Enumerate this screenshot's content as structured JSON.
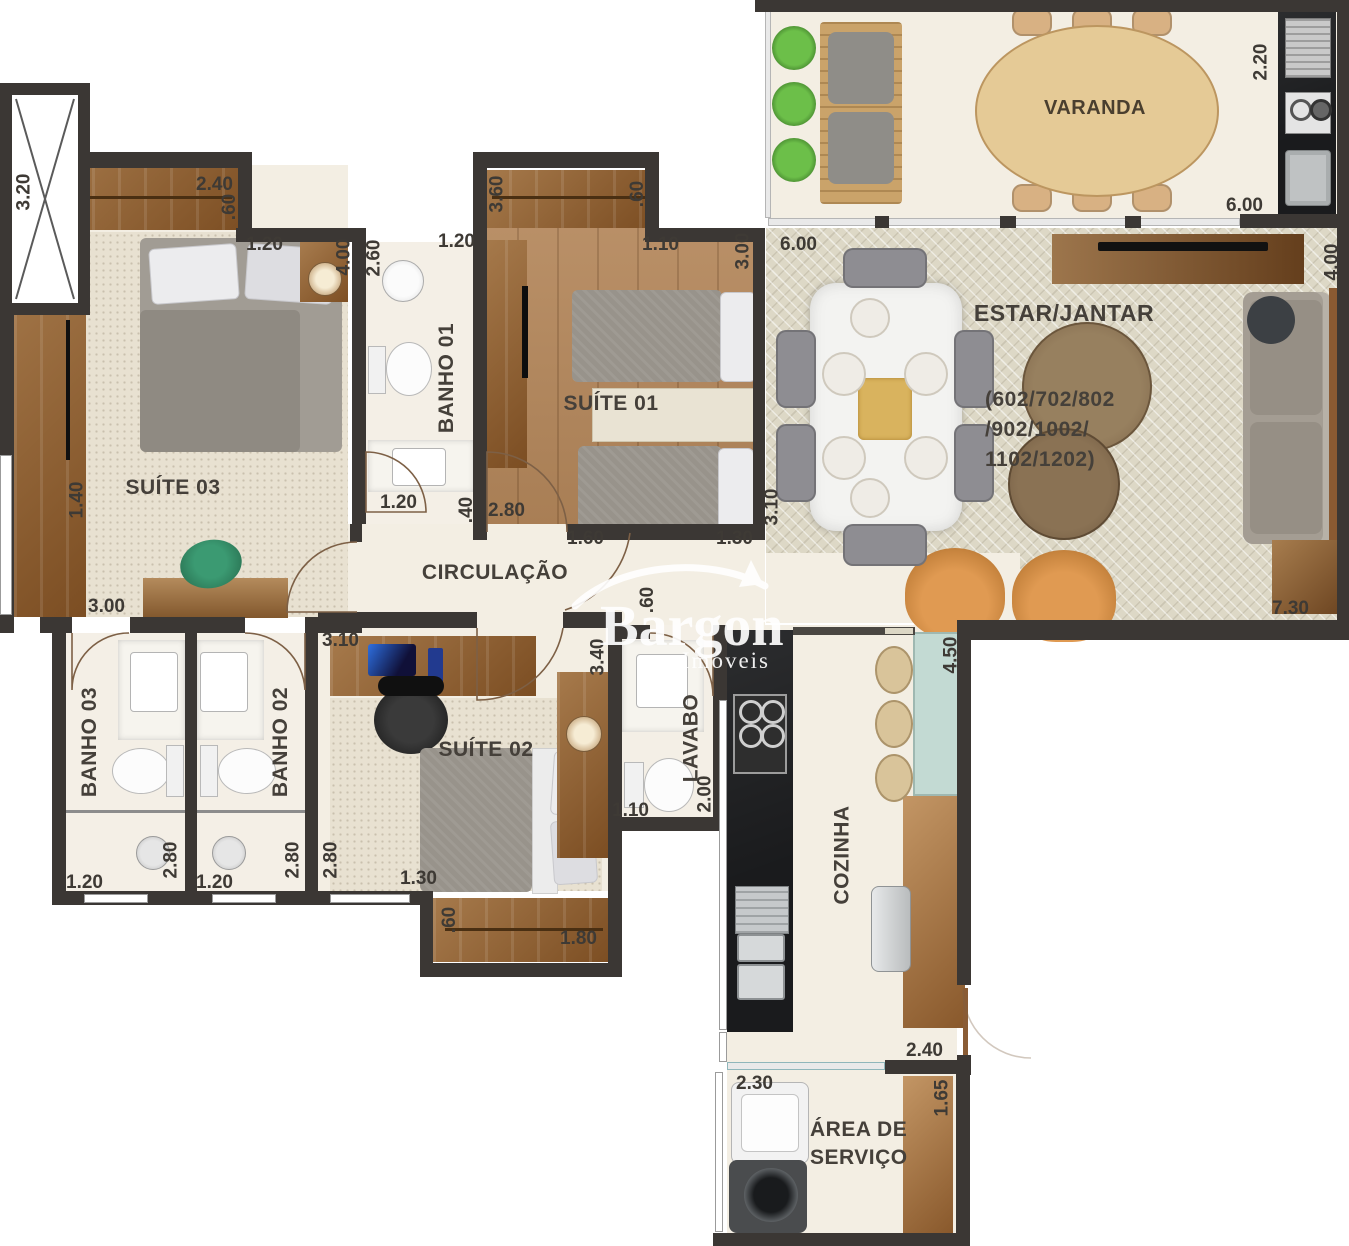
{
  "title": "Planta do apartamento (floor plan)",
  "watermark": {
    "name": "Bargon",
    "tagline": "Imóveis"
  },
  "palette": {
    "wall": "#3b3734",
    "closet_wood": "#935f2c",
    "floor_wood": "#b3865a",
    "rug": "#e8e1d1",
    "floor_cream": "#f4efe6",
    "herringbone": "#ddd8c6",
    "counter_black": "#1a1b1d",
    "counter_teal": "#c3dad3",
    "leather_chair": "#c8853f",
    "plant_green": "#5aa33d"
  },
  "rooms": {
    "varanda": "VARANDA",
    "estar": "ESTAR/JANTAR",
    "estar_units_1": "(602/702/802",
    "estar_units_2": "/902/1002/",
    "estar_units_3": "1102/1202)",
    "suite01": "SUÍTE 01",
    "suite02": "SUÍTE 02",
    "suite03": "SUÍTE 03",
    "banho01": "BANHO 01",
    "banho02": "BANHO 02",
    "banho03": "BANHO 03",
    "lavabo": "LAVABO",
    "cozinha": "COZINHA",
    "circulacao": "CIRCULAÇÃO",
    "servico_1": "ÁREA DE",
    "servico_2": "SERVIÇO"
  },
  "dims": {
    "d_320": "3.20",
    "d_240": "2.40",
    "d_60a": ".60",
    "d_120_s3": "1.20",
    "d_400_s3": "4.00",
    "d_260": "2.60",
    "d_120_b1": "1.20",
    "d_360": "3.60",
    "d_60_s1": ".60",
    "d_110_s1": "1.10",
    "d_300_s1": "3.00",
    "d_600_estar": "6.00",
    "d_220": "2.20",
    "d_600_var": "6.00",
    "d_400_estar": "4.00",
    "d_140": "1.40",
    "d_120_b1b": "1.20",
    "d_40": ".40",
    "d_280_w": "2.80",
    "d_160": "1.60",
    "d_130_s1": "1.30",
    "d_300_s3": "3.00",
    "d_310_s2": "3.10",
    "d_310_estar": "3.10",
    "d_730": "7.30",
    "d_120_b3": "1.20",
    "d_280_b3": "2.80",
    "d_120_b2": "1.20",
    "d_280_b2": "2.80",
    "d_280_s2": "2.80",
    "d_340": "3.40",
    "d_60_corr": ".60",
    "d_130_s2": "1.30",
    "d_60_s2": ".60",
    "d_180": "1.80",
    "d_200": "2.00",
    "d_110_lav": "1.10",
    "d_450": "4.50",
    "d_240_k": "2.40",
    "d_230": "2.30",
    "d_165": "1.65"
  }
}
